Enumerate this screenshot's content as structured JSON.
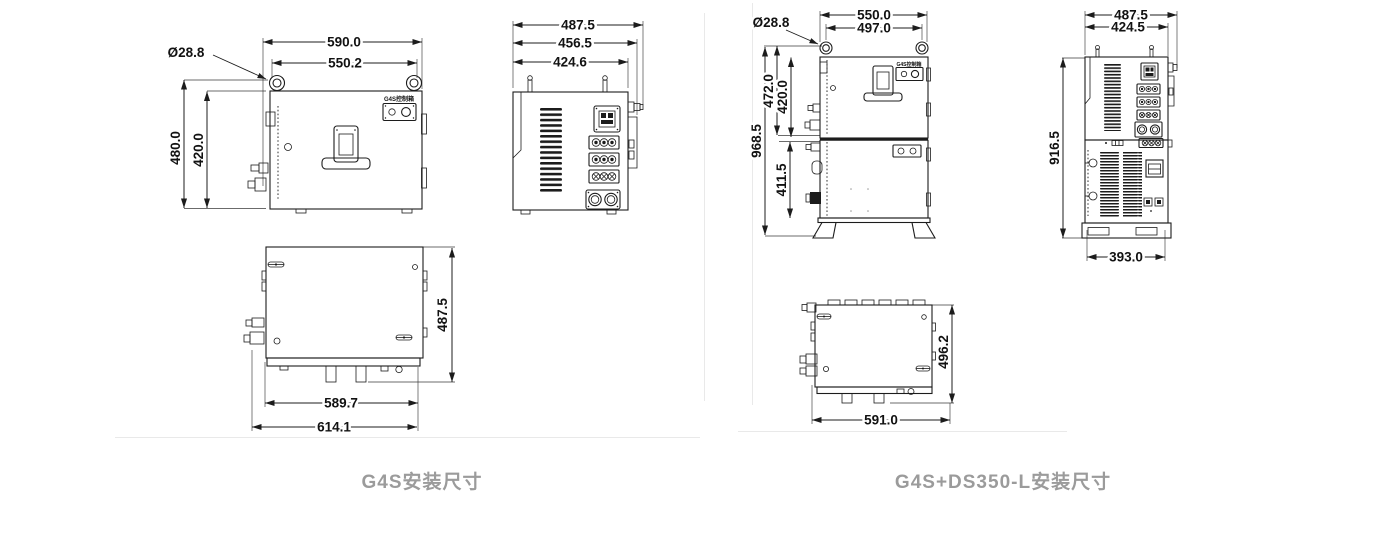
{
  "colors": {
    "line": "#1c1c1c",
    "caption_gray": "#9b9b9b",
    "divider_gray": "#e9e9e9"
  },
  "left": {
    "caption": "G4S安装尺寸",
    "box_label": "G4S控制箱",
    "front": {
      "w_outer": "590.0",
      "w_inner": "550.2",
      "eyebolt_dia": "Ø28.8",
      "h_outer": "480.0",
      "h_inner": "420.0"
    },
    "side": {
      "d_outer": "487.5",
      "d_mid": "456.5",
      "d_body": "424.6"
    },
    "top": {
      "depth": "487.5",
      "w_body": "589.7",
      "w_outer": "614.1"
    }
  },
  "right": {
    "caption": "G4S+DS350-L安装尺寸",
    "box_label": "G4S控制箱",
    "front": {
      "w_outer": "550.0",
      "w_inner": "497.0",
      "eyebolt_dia": "Ø28.8",
      "h_upper_outer": "472.0",
      "h_upper_inner": "420.0",
      "h_total": "968.5",
      "h_lower": "411.5"
    },
    "side": {
      "d_outer": "487.5",
      "d_body": "424.5",
      "height": "916.5",
      "base": "393.0"
    },
    "top": {
      "depth": "496.2",
      "width": "591.0"
    }
  }
}
